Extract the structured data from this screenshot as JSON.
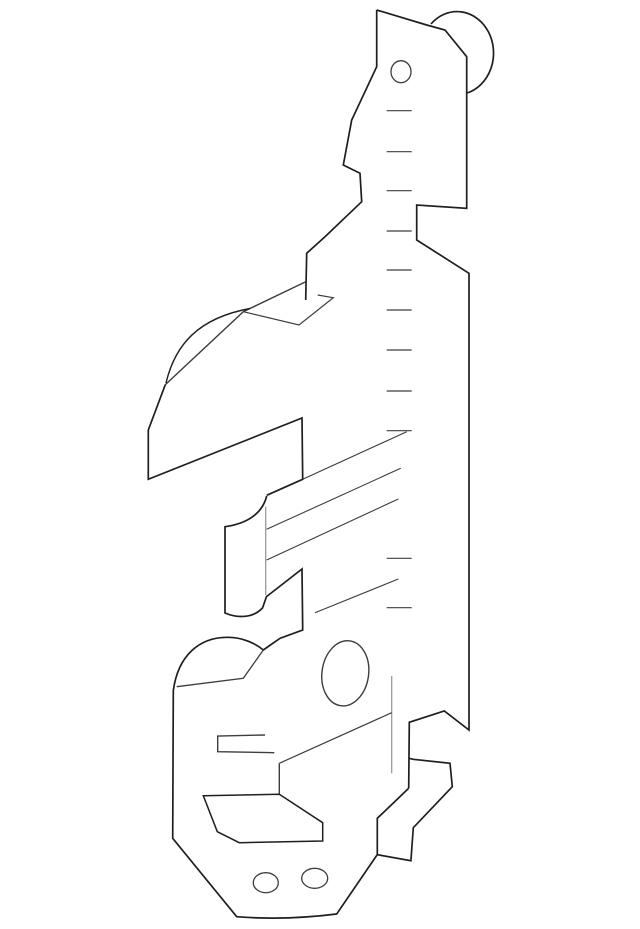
{
  "meta": {
    "description": "Technical parts-catalog line drawing of a sheet-metal bracket / guide plate, isometric style, black strokes on white background, no text or labels",
    "background_color": "#ffffff",
    "canvas": {
      "width": 640,
      "height": 929
    }
  },
  "drawing": {
    "stroke_colors": {
      "outline": "#1f1f1f",
      "thin": "#3d3d3d",
      "fold": "#9a9a9a"
    },
    "paths": [
      {
        "name": "roller-head-arc",
        "d": "M 431 24 A 36.5 41.5 0 1 1 467 93",
        "stroke": "outline",
        "width": 1.7
      },
      {
        "name": "upper-left-outline",
        "d": "M 376.7 10 L 376.7 66.7 L 351.7 120 L 343.3 165 L 360 173.3 L 361.7 201.7 L 325 236.7 L 306.7 253.3 L 305.7 300",
        "stroke": "outline",
        "width": 1.7
      },
      {
        "name": "main-plate-right-edge",
        "d": "M 376.7 10 L 426.7 25 L 445 30 L 466.7 56.7 L 466.7 208.3 L 416.7 205 L 416.7 240 L 469 273.3 L 469 730 L 444.3 711 L 409.3 722.3 L 408.7 788.3",
        "stroke": "outline",
        "width": 1.7
      },
      {
        "name": "top-bolt-hole",
        "d": "M 411 71.7 A 10 11 0 1 1 391 71.7 A 10 11 0 1 1 411 71.7",
        "stroke": "thin",
        "width": 1.3
      },
      {
        "name": "bent-tab-diagonal",
        "d": "M 305.7 281.7 L 243.3 311.7 L 165.3 384.7",
        "stroke": "thin",
        "width": 1.4
      },
      {
        "name": "bent-tab-flap",
        "d": "M 317.7 295 L 333.3 297.7 L 299 325 L 243.3 311.7",
        "stroke": "thin",
        "width": 1.2
      },
      {
        "name": "shoulder-hump-arc",
        "d": "M 166 383 C 175 345 198 318 250 308.5",
        "stroke": "outline",
        "width": 1.4
      },
      {
        "name": "mid-plate-panel",
        "d": "M 165.3 384.7 L 148.3 430 L 148.3 479.3 L 302 418 L 302.7 479.3 L 266.7 495.3",
        "stroke": "outline",
        "width": 1.7
      },
      {
        "name": "c-clip-profile",
        "d": "M 266.7 496 C 262 515 245 524 225 526.7 L 225 613 C 238 618.5 253 618 262.5 608 L 266.7 596",
        "stroke": "outline",
        "width": 1.7
      },
      {
        "name": "c-clip-fold-line",
        "d": "M 265.7 506.7 L 265.7 595",
        "stroke": "fold",
        "width": 1.3
      },
      {
        "name": "notch-plate",
        "d": "M 266.7 596.5 L 302 569 L 302.7 630 L 280 638.3",
        "stroke": "outline",
        "width": 1.7
      },
      {
        "name": "rib-line-1",
        "d": "M 302.7 479.3 L 406.7 431.7",
        "stroke": "thin",
        "width": 1.1
      },
      {
        "name": "rib-line-2",
        "d": "M 266.7 529.3 L 400.7 468.3",
        "stroke": "thin",
        "width": 1.1
      },
      {
        "name": "rib-line-3",
        "d": "M 266.7 560 L 398.3 499",
        "stroke": "thin",
        "width": 1.1
      },
      {
        "name": "rib-line-4",
        "d": "M 315 612.7 L 398.3 579",
        "stroke": "thin",
        "width": 1.1
      },
      {
        "name": "lower-body-outline",
        "d": "M 280 638.3 L 263.3 650 C 255 643 242 637.3 228 637.3 C 200 637 178 655 173.3 690.7 L 172.7 838.3 L 236.7 916.7 Q 285 920.5 336.7 914 L 377 855",
        "stroke": "outline",
        "width": 1.7
      },
      {
        "name": "lower-body-chord",
        "d": "M 176.7 686.7 L 243.3 678.3 L 263.3 650",
        "stroke": "thin",
        "width": 1.3
      },
      {
        "name": "oval-hole",
        "d": "M 349.9 640.9 A 23.3 32.7 8 1 1 340.7 705.7 A 23.3 32.7 8 1 1 349.9 640.9",
        "stroke": "thin",
        "width": 1.4
      },
      {
        "name": "hook-fold-line",
        "d": "M 391.7 676 L 391.7 773.3",
        "stroke": "fold",
        "width": 1.3
      },
      {
        "name": "body-diagonal",
        "d": "M 279.3 763.3 L 391.7 712.7",
        "stroke": "thin",
        "width": 1.2
      },
      {
        "name": "body-diagonal-drop",
        "d": "M 279.3 763.3 L 279.3 794.3",
        "stroke": "thin",
        "width": 1.4
      },
      {
        "name": "open-slot",
        "d": "M 265 735 L 217.7 736 L 217.7 751.7 L 274.3 752.7",
        "stroke": "thin",
        "width": 1.4
      },
      {
        "name": "slot-parallelogram",
        "d": "M 203.3 795.7 L 279.3 794.3 L 322.7 822.7 L 322.7 841 L 239.3 842.7 L 217.3 831.7 Z",
        "stroke": "outline",
        "width": 1.5
      },
      {
        "name": "j-hook",
        "d": "M 409 758.3 L 413.3 759.3 L 450 763.3 L 452.3 786.7 L 413.3 827.7 L 410.9 860.7 L 377.3 854.7 L 377.3 818.3 L 408.7 788.3",
        "stroke": "outline",
        "width": 1.7
      },
      {
        "name": "rivet-hole-left",
        "d": "M 278.3 882.7 A 12.5 10 0 1 1 253.3 882.7 A 12.5 10 0 1 1 278.3 882.7",
        "stroke": "thin",
        "width": 1.3
      },
      {
        "name": "rivet-hole-right",
        "d": "M 327.7 878.3 A 13 10 0 1 1 301.7 878.3 A 13 10 0 1 1 327.7 878.3",
        "stroke": "thin",
        "width": 1.3
      }
    ],
    "tick_marks": {
      "name": "ruler-tick",
      "x1": 386.7,
      "x2": 411.7,
      "ys": [
        110.7,
        151.7,
        190.7,
        231,
        270,
        310,
        350,
        391,
        430.7,
        558.3,
        607.7
      ],
      "stroke": "thin",
      "width": 1.2
    }
  }
}
